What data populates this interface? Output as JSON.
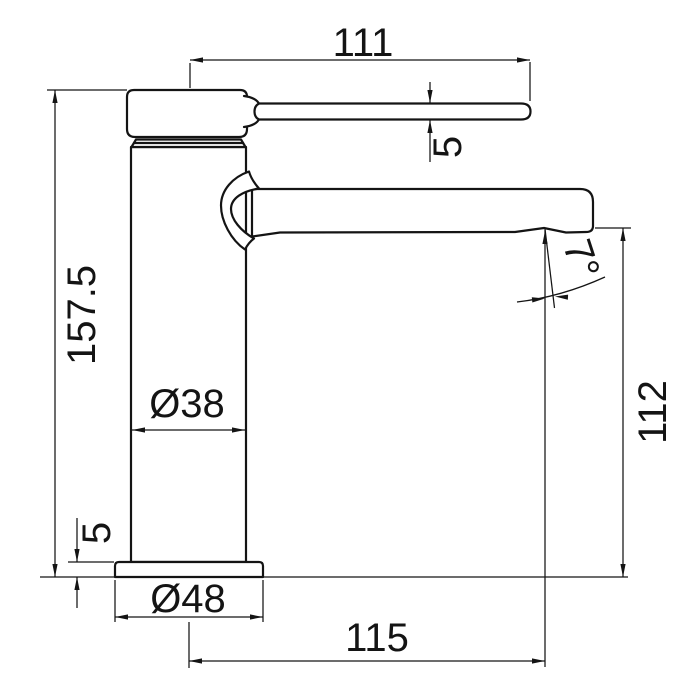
{
  "colors": {
    "line": "#141414",
    "background": "#ffffff"
  },
  "dimensions": {
    "handle_length": "111",
    "handle_thickness": "5",
    "total_height": "157.5",
    "body_diameter": "Ø38",
    "base_height": "5",
    "base_diameter": "Ø48",
    "spout_reach": "115",
    "spout_height": "112",
    "spout_angle": "7°"
  }
}
